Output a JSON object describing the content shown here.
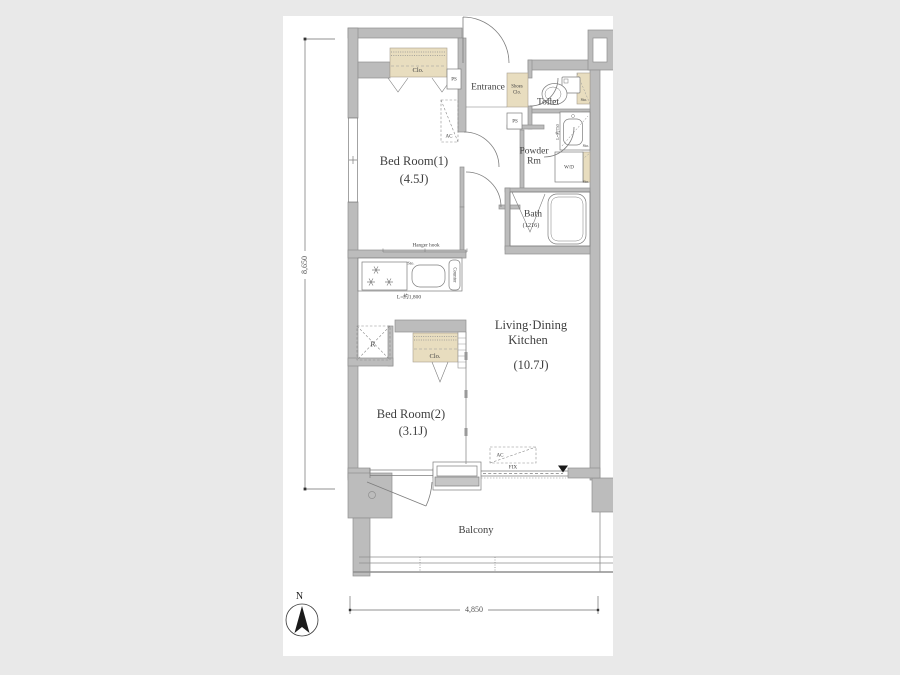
{
  "page": {
    "background": "#e9e9e9",
    "canvas": "#ffffff"
  },
  "colors": {
    "wall": "#bcbcbc",
    "wall_outline": "#8f8f8f",
    "closet_fill": "#e8ddbf",
    "fixture_line": "#7d7d7d",
    "text": "#3f3f3f"
  },
  "rooms": {
    "bedroom1": {
      "name": "Bed Room(1)",
      "size": "(4.5J)"
    },
    "bedroom2": {
      "name": "Bed Room(2)",
      "size": "(3.1J)"
    },
    "ldk": {
      "name_line1": "Living·Dining",
      "name_line2": "Kitchen",
      "size": "(10.7J)"
    },
    "entrance": {
      "name": "Entrance"
    },
    "toilet": {
      "name": "Toilet"
    },
    "powder_room": {
      "name_line1": "Powder",
      "name_line2": "Rm"
    },
    "bath": {
      "name": "Bath",
      "size": "(1216)"
    },
    "balcony": {
      "name": "Balcony"
    }
  },
  "labels": {
    "closet": "Clo.",
    "shoes_closet_line1": "Shoes",
    "shoes_closet_line2": "Clo.",
    "pipe_space": "PS",
    "air_conditioner": "AC",
    "washer_dryer": "W/D",
    "storage": "Sto.",
    "counter": "Counter",
    "refrigerator": "R",
    "hanger_hook": "Hanger hook",
    "kitchen_counter_length": "L=約1,800",
    "washbasin_length": "L=約750",
    "fixed_window": "FIX"
  },
  "dimensions": {
    "vertical": "8,650",
    "horizontal": "4,850"
  },
  "compass": {
    "north": "N"
  }
}
